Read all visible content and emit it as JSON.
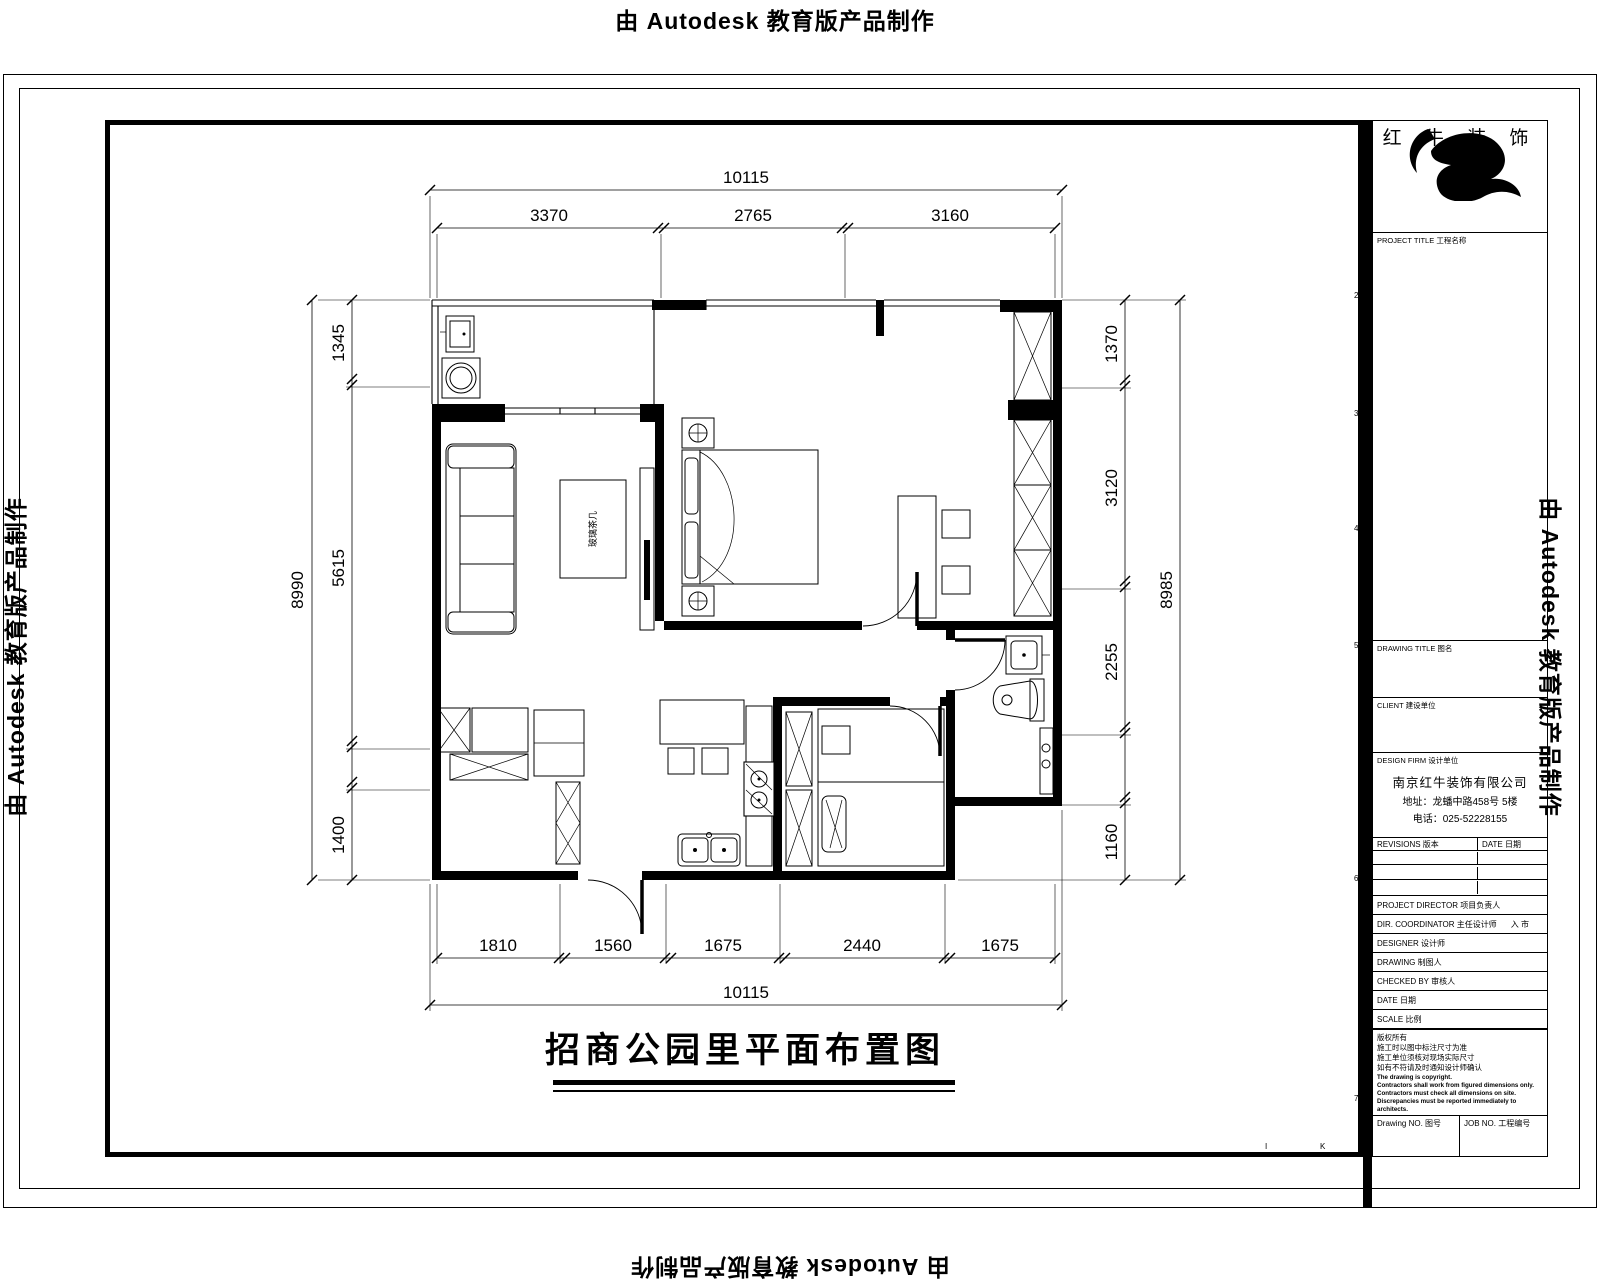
{
  "watermark": {
    "text": "由 Autodesk 教育版产品制作"
  },
  "plan": {
    "title": "招商公园里平面布置图",
    "coffee_table_label": "玻璃茶几",
    "dims": {
      "top_total": "10115",
      "top_segments": [
        "3370",
        "2765",
        "3160"
      ],
      "bottom_segments": [
        "1810",
        "1560",
        "1675",
        "2440",
        "1675"
      ],
      "bottom_total": "10115",
      "left_total": "8990",
      "left_segments": [
        "1345",
        "5615",
        "1400"
      ],
      "right_segments": [
        "1370",
        "3120",
        "2255",
        "1160"
      ],
      "right_total": "8985"
    }
  },
  "titleblock": {
    "brand": "红 牛 装 饰",
    "project_label": "PROJECT TITLE 工程名称",
    "drawing_title_label": "DRAWING TITLE 图名",
    "client_label": "CLIENT 建设单位",
    "firm_label": "DESIGN FIRM 设计单位",
    "firm_name": "南京红牛装饰有限公司",
    "firm_address": "地址：龙蟠中路458号 5楼",
    "firm_phone": "电话：025-52228155",
    "revisions_label": "REVISIONS 版本",
    "revision_date_label": "DATE 日期",
    "fields": [
      {
        "label": "PROJECT DIRECTOR 项目负责人",
        "value": ""
      },
      {
        "label": "DIR. COORDINATOR 主任设计师",
        "value": "入 市"
      },
      {
        "label": "DESIGNER 设计师",
        "value": ""
      },
      {
        "label": "DRAWING 制图人",
        "value": ""
      },
      {
        "label": "CHECKED BY 审核人",
        "value": ""
      },
      {
        "label": "DATE 日期",
        "value": ""
      },
      {
        "label": "SCALE 比例",
        "value": ""
      }
    ],
    "notes_cn": [
      "版权所有",
      "施工时以图中标注尺寸为准",
      "施工单位须核对现场实际尺寸",
      "如有不符请及时通知设计师确认"
    ],
    "notes_en": [
      "The drawing is copyright.",
      "Contractors shall work from figured dimensions only.",
      "Contractors must check all dimensions on site.",
      "Discrepancies must be reported immediately to architects."
    ],
    "drawing_no_label": "Drawing NO. 图号",
    "job_no_label": "JOB NO. 工程编号",
    "side_marks": [
      "2",
      "3",
      "4",
      "5",
      "6",
      "7"
    ],
    "bottom_marks": [
      "I",
      "K"
    ]
  }
}
